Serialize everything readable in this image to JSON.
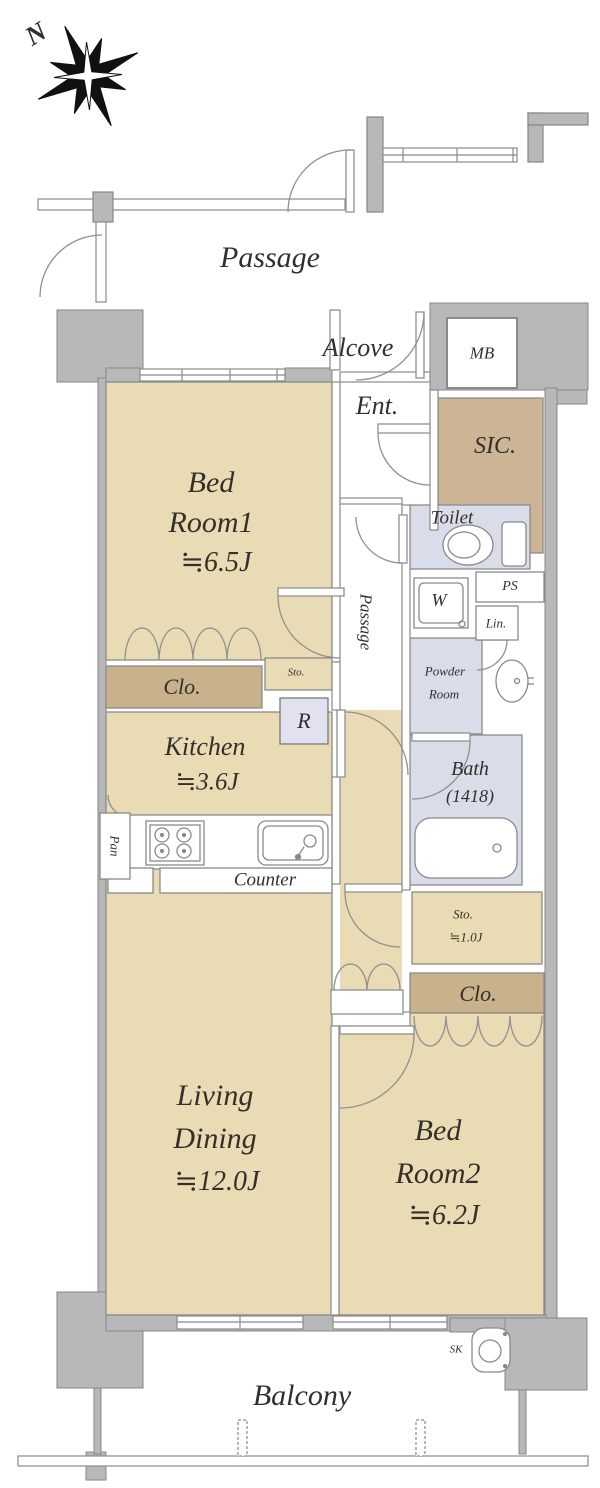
{
  "title": "Apartment floor plan",
  "colors": {
    "wall": "#b8b8b8",
    "wall_outline": "#878787",
    "room_floor": "#e9dcb4",
    "closet": "#c9b18b",
    "shoe_closet": "#cdb494",
    "wet_area": "#d9dce9",
    "fridge_box": "#e0e3ef",
    "line": "#8a8a8a",
    "text": "#33302b"
  },
  "compass": {
    "north_label": "N"
  },
  "common_area": {
    "passage_label": "Passage",
    "alcove_label": "Alcove",
    "meter_box_label": "MB"
  },
  "rooms": {
    "bedroom1": {
      "name_line1": "Bed",
      "name_line2": "Room1",
      "size": "≒6.5J"
    },
    "bedroom2": {
      "name_line1": "Bed",
      "name_line2": "Room2",
      "size": "≒6.2J"
    },
    "living_dining": {
      "name_line1": "Living",
      "name_line2": "Dining",
      "size": "≒12.0J"
    },
    "kitchen": {
      "name": "Kitchen",
      "size": "≒3.6J"
    },
    "entrance": {
      "name": "Ent."
    },
    "shoe_closet": {
      "name": "SIC."
    },
    "toilet": {
      "name": "Toilet"
    },
    "inner_passage": {
      "name": "Passage"
    },
    "powder_room": {
      "name_line1": "Powder",
      "name_line2": "Room"
    },
    "bath": {
      "name": "Bath",
      "size": "(1418)"
    },
    "storage_hall": {
      "name": "Sto."
    },
    "storage_br2": {
      "name": "Sto.",
      "size": "≒1.0J"
    },
    "closet_br1": {
      "name": "Clo."
    },
    "closet_br2": {
      "name": "Clo."
    },
    "balcony": {
      "name": "Balcony"
    }
  },
  "fixtures": {
    "counter_label": "Counter",
    "pantry_label": "Pan",
    "refrigerator_label": "R",
    "washer_label": "W",
    "pipe_space_label": "PS",
    "linen_label": "Lin.",
    "slop_sink_label": "SK"
  }
}
